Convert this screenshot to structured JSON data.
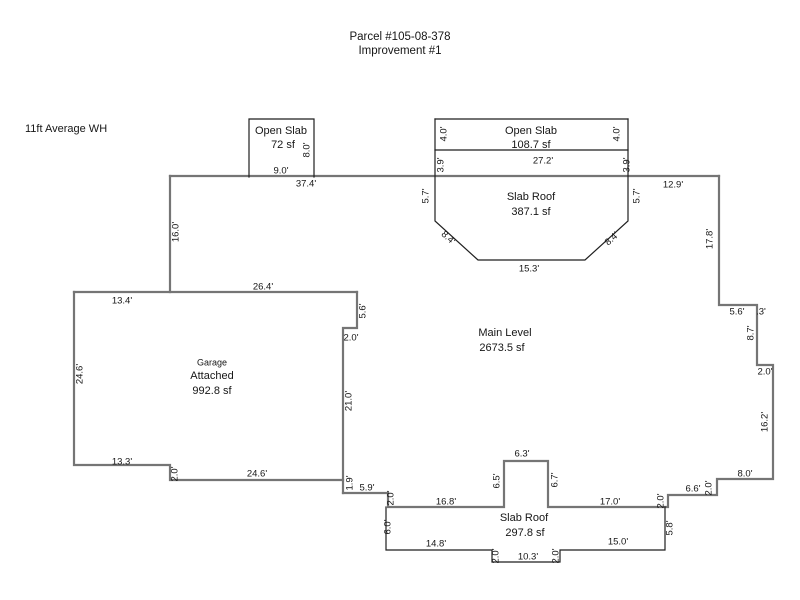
{
  "page": {
    "title_line1": "Parcel #105-08-378",
    "title_line2": "Improvement #1",
    "note": "11ft Average WH",
    "wall_color": "#757575",
    "line_color": "#1f1f1f",
    "text_color": "#161616",
    "background": "#ffffff"
  },
  "diagram": {
    "areas": [
      {
        "name": "Open Slab",
        "area": "72 sf"
      },
      {
        "name": "Open Slab",
        "area": "108.7 sf"
      },
      {
        "name": "Slab Roof",
        "area": "387.1 sf"
      },
      {
        "name": "Main Level",
        "area": "2673.5 sf"
      },
      {
        "name": "Garage Attached",
        "area": "992.8 sf"
      },
      {
        "name": "Slab Roof",
        "area": "297.8 sf"
      }
    ],
    "walls": [
      [
        [
          170,
          176
        ],
        [
          719,
          176
        ]
      ],
      [
        [
          170,
          176
        ],
        [
          170,
          292
        ]
      ],
      [
        [
          719,
          176
        ],
        [
          719,
          305
        ],
        [
          757,
          305
        ],
        [
          757,
          365
        ],
        [
          773,
          365
        ],
        [
          773,
          479
        ],
        [
          717,
          479
        ],
        [
          717,
          495
        ],
        [
          668,
          495
        ],
        [
          668,
          507
        ],
        [
          548,
          507
        ],
        [
          548,
          461
        ],
        [
          504,
          461
        ],
        [
          504,
          507
        ],
        [
          388,
          507
        ],
        [
          388,
          493
        ],
        [
          343,
          493
        ]
      ],
      [
        [
          357,
          292
        ],
        [
          357,
          328
        ],
        [
          343,
          328
        ],
        [
          343,
          493
        ]
      ],
      [
        [
          74,
          292
        ],
        [
          357,
          292
        ]
      ],
      [
        [
          74,
          292
        ],
        [
          74,
          465
        ],
        [
          170,
          465
        ],
        [
          170,
          480
        ],
        [
          343,
          480
        ]
      ]
    ],
    "attachments": [
      [
        [
          249,
          177
        ],
        [
          249,
          119
        ],
        [
          314,
          119
        ],
        [
          314,
          177
        ]
      ],
      [
        [
          435,
          119
        ],
        [
          628,
          119
        ]
      ],
      [
        [
          435,
          119
        ],
        [
          435,
          221
        ],
        [
          478,
          260
        ],
        [
          585,
          260
        ],
        [
          628,
          221
        ],
        [
          628,
          119
        ]
      ],
      [
        [
          435,
          150
        ],
        [
          628,
          150
        ]
      ],
      [
        [
          386,
          507
        ],
        [
          386,
          550
        ],
        [
          492,
          550
        ],
        [
          492,
          562
        ],
        [
          560,
          562
        ],
        [
          560,
          550
        ],
        [
          665,
          550
        ],
        [
          665,
          507
        ]
      ]
    ],
    "labels": [
      {
        "t": "Open Slab",
        "x": 281,
        "y": 131,
        "s": 11,
        "n": "room-name"
      },
      {
        "t": "72 sf",
        "x": 283,
        "y": 145,
        "s": 11,
        "n": "room-area"
      },
      {
        "t": "Open Slab",
        "x": 531,
        "y": 131,
        "s": 11,
        "n": "room-name"
      },
      {
        "t": "108.7 sf",
        "x": 531,
        "y": 145,
        "s": 11,
        "n": "room-area"
      },
      {
        "t": "Slab Roof",
        "x": 531,
        "y": 197,
        "s": 11,
        "n": "room-name"
      },
      {
        "t": "387.1 sf",
        "x": 531,
        "y": 212,
        "s": 11,
        "n": "room-area"
      },
      {
        "t": "Main Level",
        "x": 505,
        "y": 333,
        "s": 11,
        "n": "room-name"
      },
      {
        "t": "2673.5 sf",
        "x": 502,
        "y": 348,
        "s": 11,
        "n": "room-area"
      },
      {
        "t": "Garage",
        "x": 212,
        "y": 363,
        "s": 9,
        "n": "room-name"
      },
      {
        "t": "Attached",
        "x": 212,
        "y": 376,
        "s": 11,
        "n": "room-name"
      },
      {
        "t": "992.8 sf",
        "x": 212,
        "y": 391,
        "s": 11,
        "n": "room-area"
      },
      {
        "t": "Slab Roof",
        "x": 524,
        "y": 518,
        "s": 11,
        "n": "room-name"
      },
      {
        "t": "297.8 sf",
        "x": 525,
        "y": 533,
        "s": 11,
        "n": "room-area"
      },
      {
        "t": "8.0'",
        "x": 307,
        "y": 150,
        "r": -90,
        "s": 9.5
      },
      {
        "t": "9.0'",
        "x": 281,
        "y": 171,
        "s": 9.5
      },
      {
        "t": "37.4'",
        "x": 306,
        "y": 184,
        "s": 9.5
      },
      {
        "t": "4.0'",
        "x": 444,
        "y": 134,
        "r": -90,
        "s": 9.5
      },
      {
        "t": "4.0'",
        "x": 617,
        "y": 134,
        "r": -90,
        "s": 9.5
      },
      {
        "t": "27.2'",
        "x": 543,
        "y": 161,
        "s": 9.5
      },
      {
        "t": "3.9'",
        "x": 441,
        "y": 165,
        "r": -90,
        "s": 9.5
      },
      {
        "t": "3.9'",
        "x": 627,
        "y": 165,
        "r": -90,
        "s": 9.5
      },
      {
        "t": "5.7'",
        "x": 426,
        "y": 196,
        "r": -90,
        "s": 9.5
      },
      {
        "t": "5.7'",
        "x": 637,
        "y": 196,
        "r": -90,
        "s": 9.5
      },
      {
        "t": "8.4'",
        "x": 448,
        "y": 238,
        "r": 42,
        "s": 9.5
      },
      {
        "t": "8.4'",
        "x": 612,
        "y": 239,
        "r": -42,
        "s": 9.5
      },
      {
        "t": "15.3'",
        "x": 529,
        "y": 269,
        "s": 9.5
      },
      {
        "t": "12.9'",
        "x": 673,
        "y": 185,
        "s": 9.5
      },
      {
        "t": "16.0'",
        "x": 176,
        "y": 232,
        "r": -90,
        "s": 9.5
      },
      {
        "t": "17.8'",
        "x": 710,
        "y": 239,
        "r": -90,
        "s": 9.5
      },
      {
        "t": "5.6'",
        "x": 737,
        "y": 312,
        "s": 9.5
      },
      {
        "t": ".3'",
        "x": 761,
        "y": 312,
        "s": 9.5
      },
      {
        "t": "8.7'",
        "x": 751,
        "y": 333,
        "r": -90,
        "s": 9.5
      },
      {
        "t": "2.0'",
        "x": 765,
        "y": 372,
        "s": 9.5
      },
      {
        "t": "16.2'",
        "x": 765,
        "y": 422,
        "r": -90,
        "s": 9.5
      },
      {
        "t": "8.0'",
        "x": 745,
        "y": 474,
        "s": 9.5
      },
      {
        "t": "2.0'",
        "x": 709,
        "y": 488,
        "r": -90,
        "s": 9.5
      },
      {
        "t": "6.6'",
        "x": 693,
        "y": 489,
        "s": 9.5
      },
      {
        "t": "2.0'",
        "x": 661,
        "y": 501,
        "r": -90,
        "s": 9.5
      },
      {
        "t": "17.0'",
        "x": 610,
        "y": 502,
        "s": 9.5
      },
      {
        "t": "6.7'",
        "x": 555,
        "y": 480,
        "r": -90,
        "s": 9.5
      },
      {
        "t": "6.3'",
        "x": 522,
        "y": 454,
        "s": 9.5
      },
      {
        "t": "6.5'",
        "x": 497,
        "y": 481,
        "r": -90,
        "s": 9.5
      },
      {
        "t": "16.8'",
        "x": 446,
        "y": 502,
        "s": 9.5
      },
      {
        "t": "2.0'",
        "x": 391,
        "y": 498,
        "r": -90,
        "s": 9.5
      },
      {
        "t": "5.9'",
        "x": 367,
        "y": 488,
        "s": 9.5
      },
      {
        "t": "1.9'",
        "x": 350,
        "y": 483,
        "r": -90,
        "s": 9.5
      },
      {
        "t": "26.4'",
        "x": 263,
        "y": 287,
        "s": 9.5
      },
      {
        "t": "13.4'",
        "x": 122,
        "y": 301,
        "s": 9.5
      },
      {
        "t": "5.6'",
        "x": 363,
        "y": 311,
        "r": -90,
        "s": 9.5
      },
      {
        "t": "2.0'",
        "x": 351,
        "y": 338,
        "s": 9.5
      },
      {
        "t": "21.0'",
        "x": 349,
        "y": 401,
        "r": -90,
        "s": 9.5
      },
      {
        "t": "24.6'",
        "x": 80,
        "y": 374,
        "r": -90,
        "s": 9.5
      },
      {
        "t": "13.3'",
        "x": 122,
        "y": 462,
        "s": 9.5
      },
      {
        "t": "2.0'",
        "x": 175,
        "y": 474,
        "r": -90,
        "s": 9.5
      },
      {
        "t": "24.6'",
        "x": 257,
        "y": 474,
        "s": 9.5
      },
      {
        "t": "6.0'",
        "x": 388,
        "y": 527,
        "r": -90,
        "s": 9.5
      },
      {
        "t": "14.8'",
        "x": 436,
        "y": 544,
        "s": 9.5
      },
      {
        "t": "2.0'",
        "x": 496,
        "y": 556,
        "r": -90,
        "s": 9.5
      },
      {
        "t": "10.3'",
        "x": 528,
        "y": 557,
        "s": 9.5
      },
      {
        "t": "2.0'",
        "x": 556,
        "y": 556,
        "r": -90,
        "s": 9.5
      },
      {
        "t": "15.0'",
        "x": 618,
        "y": 542,
        "s": 9.5
      },
      {
        "t": "5.8'",
        "x": 670,
        "y": 528,
        "r": -90,
        "s": 9.5
      }
    ]
  }
}
